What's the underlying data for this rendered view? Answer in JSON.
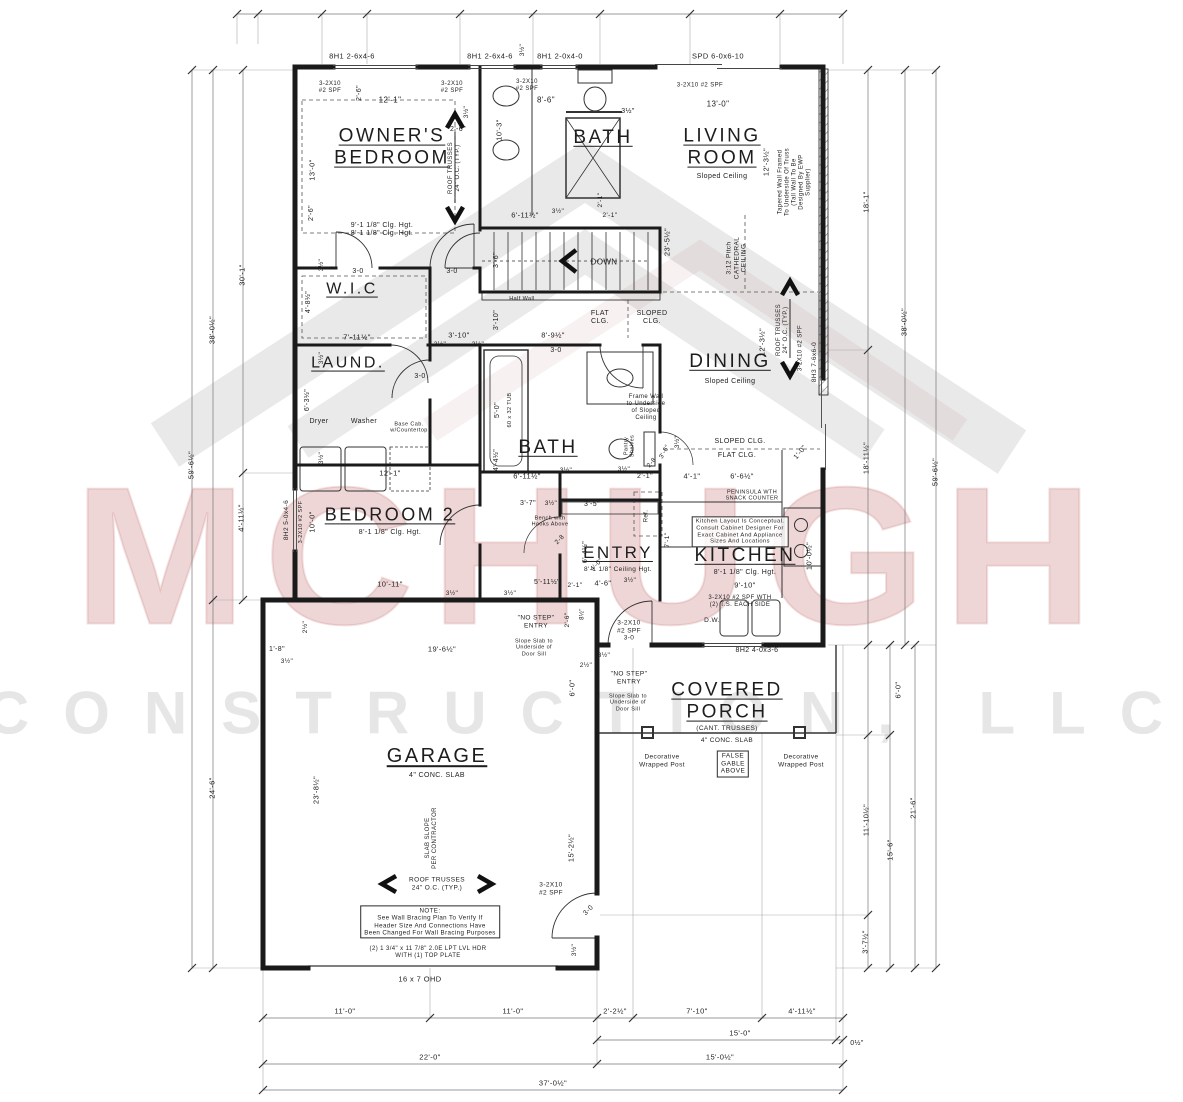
{
  "drawing": {
    "type": "Residential first-floor construction plan"
  },
  "watermark": {
    "line1": "MCHUGH",
    "line2": "CONSTRUCTION, LLC",
    "accent_color": "#cd8080"
  },
  "rooms": [
    {
      "name": "OWNER'S BEDROOM",
      "note": "9'-1 1/8\" Clg. Hgt. / 8'-1 1/8\" Clg. Hgt."
    },
    {
      "name": "BATH",
      "note": "upper bath"
    },
    {
      "name": "LIVING ROOM",
      "note": "Sloped Ceiling"
    },
    {
      "name": "W.I.C",
      "note": ""
    },
    {
      "name": "LAUND.",
      "note": ""
    },
    {
      "name": "DINING",
      "note": "Sloped Ceiling"
    },
    {
      "name": "BATH",
      "note": "hall bath"
    },
    {
      "name": "BEDROOM 2",
      "note": "8'-1 1/8\" Clg. Hgt."
    },
    {
      "name": "ENTRY",
      "note": "8'-1 1/8\" Ceiling Hgt."
    },
    {
      "name": "KITCHEN",
      "note": "8'-1 1/8\" Clg. Hgt."
    },
    {
      "name": "COVERED PORCH",
      "note": "(CANT. TRUSSES) 4\" CONC. SLAB"
    },
    {
      "name": "GARAGE",
      "note": "4\" CONC. SLAB"
    }
  ],
  "labels": [
    {
      "t": "8H1 2-6x4-6",
      "x": 352,
      "y": 57,
      "s": 7.5
    },
    {
      "t": "8H1 2-6x4-6",
      "x": 490,
      "y": 57,
      "s": 7.5
    },
    {
      "t": "8H1 2-0x4-0",
      "x": 560,
      "y": 57,
      "s": 7.5
    },
    {
      "t": "SPD 6-0x6-10",
      "x": 718,
      "y": 57,
      "s": 7.5
    },
    {
      "t": "3½\"",
      "x": 523,
      "y": 50,
      "s": 6.5,
      "r": -90
    },
    {
      "t": "3-2X10\n#2 SPF",
      "x": 330,
      "y": 88,
      "s": 6
    },
    {
      "t": "3-2X10\n#2 SPF",
      "x": 452,
      "y": 88,
      "s": 6
    },
    {
      "t": "3-2X10\n#2 SPF",
      "x": 527,
      "y": 86,
      "s": 6
    },
    {
      "t": "3-2X10 #2 SPF",
      "x": 700,
      "y": 86,
      "s": 6
    },
    {
      "t": "12'-1\"",
      "x": 390,
      "y": 100,
      "s": 8
    },
    {
      "t": "8'-6\"",
      "x": 546,
      "y": 100,
      "s": 8
    },
    {
      "t": "13'-0\"",
      "x": 718,
      "y": 104,
      "s": 8
    },
    {
      "t": "10'-3\"",
      "x": 500,
      "y": 130,
      "s": 7.5,
      "r": -90
    },
    {
      "t": "3½\"",
      "x": 628,
      "y": 112,
      "s": 7
    },
    {
      "t": "2'-6\"",
      "x": 360,
      "y": 93,
      "s": 7,
      "r": -90
    },
    {
      "t": "2'-6\"",
      "x": 458,
      "y": 130,
      "s": 7
    },
    {
      "t": "3½\"",
      "x": 467,
      "y": 112,
      "s": 6.5,
      "r": -90
    },
    {
      "t": "13'-0\"",
      "x": 313,
      "y": 170,
      "s": 7.5,
      "r": -90
    },
    {
      "t": "2'-6\"",
      "x": 312,
      "y": 213,
      "s": 7,
      "r": -90
    },
    {
      "t": "OWNER'S\nBEDROOM",
      "x": 392,
      "y": 148,
      "s": 19,
      "u": 1,
      "n": "room-label-owners-bedroom"
    },
    {
      "t": "BATH",
      "x": 603,
      "y": 138,
      "s": 19,
      "u": 1,
      "n": "room-label-bath-1"
    },
    {
      "t": "LIVING\nROOM",
      "x": 722,
      "y": 148,
      "s": 19,
      "u": 1,
      "n": "room-label-living-room"
    },
    {
      "t": "Sloped Ceiling",
      "x": 722,
      "y": 177,
      "s": 7
    },
    {
      "t": "ROOF TRUSSES\n24\" O.C. (TYP.)",
      "x": 455,
      "y": 168,
      "s": 6,
      "r": -90
    },
    {
      "t": "9'-1 1/8\" Clg. Hgt.\n8'-1 1/8\" Clg. Hgt.",
      "x": 382,
      "y": 230,
      "s": 7
    },
    {
      "t": "12'-3½\"",
      "x": 767,
      "y": 162,
      "s": 7.5,
      "r": -90
    },
    {
      "t": "Tapered Wall Framed\nTo Underside Of Truss\n(Tall Wall To Be\nDesigned By EWP\nSupplier)",
      "x": 795,
      "y": 182,
      "s": 6,
      "r": -90
    },
    {
      "t": "18'-1\"",
      "x": 867,
      "y": 202,
      "s": 7.5,
      "r": -90
    },
    {
      "t": "3:12 Pitch\nCATHEDRAL\nCEILING",
      "x": 737,
      "y": 258,
      "s": 6.5,
      "r": -90
    },
    {
      "t": "23'-5½\"",
      "x": 668,
      "y": 242,
      "s": 7.5,
      "r": -90
    },
    {
      "t": "2'-1\"",
      "x": 601,
      "y": 200,
      "s": 6.5,
      "r": -90
    },
    {
      "t": "6'-11½\"",
      "x": 525,
      "y": 216,
      "s": 7.5
    },
    {
      "t": "3½\"",
      "x": 558,
      "y": 212,
      "s": 6.5
    },
    {
      "t": "2'-1\"",
      "x": 610,
      "y": 216,
      "s": 6.5
    },
    {
      "t": "3-0",
      "x": 358,
      "y": 272,
      "s": 7
    },
    {
      "t": "3-0",
      "x": 452,
      "y": 272,
      "s": 7
    },
    {
      "t": "3'-6\"",
      "x": 497,
      "y": 260,
      "s": 7,
      "r": -90
    },
    {
      "t": "DOWN",
      "x": 604,
      "y": 262,
      "s": 8,
      "n": "stairs-down-label"
    },
    {
      "t": "Half Wall",
      "x": 522,
      "y": 299,
      "s": 5.5
    },
    {
      "t": "W.I.C",
      "x": 352,
      "y": 290,
      "s": 16,
      "u": 1,
      "n": "room-label-wic"
    },
    {
      "t": "4'-8½\"",
      "x": 309,
      "y": 302,
      "s": 7,
      "r": -90
    },
    {
      "t": "3½\"",
      "x": 322,
      "y": 265,
      "s": 6.5,
      "r": -90
    },
    {
      "t": "7'-11½\"",
      "x": 357,
      "y": 338,
      "s": 7.5
    },
    {
      "t": "3'-10\"",
      "x": 459,
      "y": 336,
      "s": 7.5
    },
    {
      "t": "3½\"",
      "x": 440,
      "y": 345,
      "s": 6.5
    },
    {
      "t": "3½\"",
      "x": 478,
      "y": 345,
      "s": 6.5
    },
    {
      "t": "8'-9½\"",
      "x": 553,
      "y": 336,
      "s": 7.5
    },
    {
      "t": "3'-10\"",
      "x": 497,
      "y": 320,
      "s": 7,
      "r": -90
    },
    {
      "t": "FLAT\nCLG.",
      "x": 600,
      "y": 318,
      "s": 7
    },
    {
      "t": "SLOPED\nCLG.",
      "x": 652,
      "y": 318,
      "s": 7
    },
    {
      "t": "LAUND.",
      "x": 348,
      "y": 364,
      "s": 16,
      "u": 1,
      "n": "room-label-laundry"
    },
    {
      "t": "3-0",
      "x": 420,
      "y": 377,
      "s": 7
    },
    {
      "t": "6'-3½\"",
      "x": 308,
      "y": 400,
      "s": 7,
      "r": -90
    },
    {
      "t": "3½\"",
      "x": 322,
      "y": 358,
      "s": 6.5,
      "r": -90
    },
    {
      "t": "Dryer",
      "x": 319,
      "y": 422,
      "s": 7
    },
    {
      "t": "Washer",
      "x": 364,
      "y": 422,
      "s": 7
    },
    {
      "t": "Base Cab.\nw/Countertop",
      "x": 409,
      "y": 428,
      "s": 5.5
    },
    {
      "t": "3½\"",
      "x": 322,
      "y": 458,
      "s": 6.5,
      "r": -90
    },
    {
      "t": "12'-1\"",
      "x": 390,
      "y": 474,
      "s": 7.5
    },
    {
      "t": "DINING",
      "x": 730,
      "y": 362,
      "s": 19,
      "u": 1,
      "n": "room-label-dining"
    },
    {
      "t": "Sloped Ceiling",
      "x": 730,
      "y": 382,
      "s": 7
    },
    {
      "t": "12'-3½\"",
      "x": 763,
      "y": 342,
      "s": 7.5,
      "r": -90
    },
    {
      "t": "ROOF TRUSSES\n24\" O.C. (TYP.)",
      "x": 783,
      "y": 330,
      "s": 6,
      "r": -90
    },
    {
      "t": "3-2X10 #2 SPF",
      "x": 801,
      "y": 348,
      "s": 6,
      "r": -90
    },
    {
      "t": "8H3 7-6x6-0",
      "x": 815,
      "y": 362,
      "s": 6.5,
      "r": -90
    },
    {
      "t": "38'-0½\"",
      "x": 905,
      "y": 322,
      "s": 7.5,
      "r": -90
    },
    {
      "t": "59'-6½\"",
      "x": 936,
      "y": 472,
      "s": 7.5,
      "r": -90
    },
    {
      "t": "18'-11½\"",
      "x": 867,
      "y": 458,
      "s": 7.5,
      "r": -90
    },
    {
      "t": "BATH",
      "x": 548,
      "y": 448,
      "s": 19,
      "u": 1,
      "n": "room-label-bath-2"
    },
    {
      "t": "5'-0\"",
      "x": 498,
      "y": 410,
      "s": 7,
      "r": -90
    },
    {
      "t": "60 x 32 TUB",
      "x": 510,
      "y": 410,
      "s": 5.5,
      "r": -90
    },
    {
      "t": "3-0",
      "x": 556,
      "y": 351,
      "s": 7
    },
    {
      "t": "Frame Wall\nto Underside\nof Sloped\nCeiling",
      "x": 646,
      "y": 408,
      "s": 6
    },
    {
      "t": "SLOPED CLG.",
      "x": 740,
      "y": 442,
      "s": 7
    },
    {
      "t": "FLAT CLG.",
      "x": 737,
      "y": 456,
      "s": 7
    },
    {
      "t": "1'-0\"",
      "x": 801,
      "y": 453,
      "s": 7,
      "r": -50
    },
    {
      "t": "4'-4½\"",
      "x": 497,
      "y": 460,
      "s": 7,
      "r": -90
    },
    {
      "t": "6'-11½\"",
      "x": 527,
      "y": 477,
      "s": 7.5
    },
    {
      "t": "3½\"",
      "x": 566,
      "y": 471,
      "s": 6.5
    },
    {
      "t": "2'-1\"",
      "x": 645,
      "y": 477,
      "s": 7
    },
    {
      "t": "3½\"",
      "x": 624,
      "y": 470,
      "s": 6.5
    },
    {
      "t": "Pantry\nShelves",
      "x": 630,
      "y": 446,
      "s": 5.5,
      "r": -90
    },
    {
      "t": "2-8",
      "x": 652,
      "y": 463,
      "s": 6.5,
      "r": -50
    },
    {
      "t": "3'-6\"",
      "x": 665,
      "y": 452,
      "s": 6.5,
      "r": -60
    },
    {
      "t": "4'-1\"",
      "x": 692,
      "y": 477,
      "s": 7.5
    },
    {
      "t": "6'-6½\"",
      "x": 742,
      "y": 477,
      "s": 7.5
    },
    {
      "t": "3½\"",
      "x": 678,
      "y": 442,
      "s": 6.5,
      "r": -90
    },
    {
      "t": "PENINSULA WTH\nSNACK COUNTER",
      "x": 752,
      "y": 496,
      "s": 5.5
    },
    {
      "t": "BEDROOM 2",
      "x": 390,
      "y": 515,
      "s": 18,
      "u": 1,
      "n": "room-label-bedroom-2"
    },
    {
      "t": "8'-1 1/8\" Clg. Hgt.",
      "x": 390,
      "y": 533,
      "s": 7
    },
    {
      "t": "10'-0\"",
      "x": 313,
      "y": 522,
      "s": 7.5,
      "r": -90
    },
    {
      "t": "8H2 5-0x4-6",
      "x": 287,
      "y": 520,
      "s": 6.5,
      "r": -90
    },
    {
      "t": "3-2X10 #2 SPF",
      "x": 301,
      "y": 522,
      "s": 5.5,
      "r": -90
    },
    {
      "t": "10'-11\"",
      "x": 390,
      "y": 585,
      "s": 7.5
    },
    {
      "t": "3½\"",
      "x": 452,
      "y": 594,
      "s": 6.5
    },
    {
      "t": "2'-1\"",
      "x": 575,
      "y": 586,
      "s": 6.5
    },
    {
      "t": "3½\"",
      "x": 510,
      "y": 594,
      "s": 6.5
    },
    {
      "t": "5'-11½\"",
      "x": 547,
      "y": 583,
      "s": 7
    },
    {
      "t": "30'-1\"",
      "x": 243,
      "y": 275,
      "s": 7.5,
      "r": -90
    },
    {
      "t": "38'-0½\"",
      "x": 213,
      "y": 330,
      "s": 7.5,
      "r": -90
    },
    {
      "t": "59'-6½\"",
      "x": 192,
      "y": 465,
      "s": 7.5,
      "r": -90
    },
    {
      "t": "4'-11½\"",
      "x": 242,
      "y": 518,
      "s": 7.5,
      "r": -90
    },
    {
      "t": "ENTRY",
      "x": 618,
      "y": 553,
      "s": 17,
      "u": 1,
      "n": "room-label-entry"
    },
    {
      "t": "8'-1 1/8\" Ceiling Hgt.",
      "x": 618,
      "y": 570,
      "s": 6.5
    },
    {
      "t": "4'-6\"",
      "x": 603,
      "y": 584,
      "s": 7.5
    },
    {
      "t": "3½\"",
      "x": 630,
      "y": 581,
      "s": 6.5
    },
    {
      "t": "KITCHEN",
      "x": 745,
      "y": 556,
      "s": 19,
      "u": 1,
      "n": "room-label-kitchen"
    },
    {
      "t": "8'-1 1/8\" Clg. Hgt.",
      "x": 745,
      "y": 573,
      "s": 7
    },
    {
      "t": "9'-10\"",
      "x": 745,
      "y": 586,
      "s": 7.5
    },
    {
      "t": "Kitchen Layout Is Conceptual.\nConsult Cabinet Designer For\nExact Cabinet And Appliance\nSizes And Locations",
      "x": 740,
      "y": 532,
      "s": 5.8,
      "bx": 1
    },
    {
      "t": "10'-0½\"",
      "x": 810,
      "y": 556,
      "s": 7.5,
      "r": -90
    },
    {
      "t": "3-2X10 #2 SPF WTH\n(2) T.S. EACH SIDE",
      "x": 740,
      "y": 602,
      "s": 6
    },
    {
      "t": "D.W.",
      "x": 712,
      "y": 621,
      "s": 6.5
    },
    {
      "t": "Ref.",
      "x": 647,
      "y": 516,
      "s": 6,
      "r": -90
    },
    {
      "t": "7'-1\"",
      "x": 668,
      "y": 540,
      "s": 6.5,
      "r": -90
    },
    {
      "t": "3'-7\"",
      "x": 528,
      "y": 504,
      "s": 7
    },
    {
      "t": "3½\"",
      "x": 551,
      "y": 504,
      "s": 6.5
    },
    {
      "t": "3'-5\"",
      "x": 592,
      "y": 505,
      "s": 7
    },
    {
      "t": "Bench with\nHooks Above",
      "x": 550,
      "y": 522,
      "s": 5.5
    },
    {
      "t": "2-8",
      "x": 560,
      "y": 540,
      "s": 6.5,
      "r": -45
    },
    {
      "t": "6'-4½\"",
      "x": 586,
      "y": 552,
      "s": 7,
      "r": -90
    },
    {
      "t": "4'-0\"",
      "x": 597,
      "y": 565,
      "s": 6.5,
      "r": -45
    },
    {
      "t": "3-2X10\n#2 SPF\n3-0",
      "x": 629,
      "y": 631,
      "s": 6.5
    },
    {
      "t": "2'-6\"",
      "x": 568,
      "y": 620,
      "s": 6.5,
      "r": -90
    },
    {
      "t": "8½\"",
      "x": 583,
      "y": 614,
      "s": 6,
      "r": -90
    },
    {
      "t": "\"NO STEP\"\nENTRY",
      "x": 536,
      "y": 622,
      "s": 6.5
    },
    {
      "t": "Slope Slab to\nUnderside of\nDoor Sill",
      "x": 534,
      "y": 648,
      "s": 5.5
    },
    {
      "t": "3½\"",
      "x": 604,
      "y": 656,
      "s": 6.5
    },
    {
      "t": "2½\"",
      "x": 586,
      "y": 666,
      "s": 6.5
    },
    {
      "t": "19'-6½\"",
      "x": 442,
      "y": 650,
      "s": 7.5
    },
    {
      "t": "1'-8\"",
      "x": 277,
      "y": 650,
      "s": 7
    },
    {
      "t": "3½\"",
      "x": 287,
      "y": 662,
      "s": 6.5
    },
    {
      "t": "2½\"",
      "x": 306,
      "y": 627,
      "s": 6.5,
      "r": -90
    },
    {
      "t": "24'-6\"",
      "x": 213,
      "y": 788,
      "s": 7.5,
      "r": -90
    },
    {
      "t": "23'-8½\"",
      "x": 317,
      "y": 790,
      "s": 7.5,
      "r": -90
    },
    {
      "t": "GARAGE",
      "x": 437,
      "y": 757,
      "s": 20,
      "u": 1,
      "n": "room-label-garage"
    },
    {
      "t": "4\" CONC. SLAB",
      "x": 437,
      "y": 776,
      "s": 7
    },
    {
      "t": "SLAB SLOPE\nPER CONTRACTOR",
      "x": 432,
      "y": 838,
      "s": 6,
      "r": -90
    },
    {
      "t": "ROOF TRUSSES\n24\" O.C. (TYP.)",
      "x": 437,
      "y": 884,
      "s": 6.5
    },
    {
      "t": "NOTE:\nSee Wall Bracing Plan To Verify If\nHeader Size And Connections Have\nBeen Changed For Wall Bracing Purposes",
      "x": 430,
      "y": 922,
      "s": 6.2,
      "bx": 1
    },
    {
      "t": "(2) 1 3/4\" x 11 7/8\" 2.0E LPT LVL HDR\nWITH (1) TOP PLATE",
      "x": 428,
      "y": 953,
      "s": 6
    },
    {
      "t": "16 x 7 OHD",
      "x": 420,
      "y": 980,
      "s": 7.5
    },
    {
      "t": "6'-0\"",
      "x": 573,
      "y": 688,
      "s": 7.5,
      "r": -90
    },
    {
      "t": "15'-2½\"",
      "x": 572,
      "y": 848,
      "s": 7.5,
      "r": -90
    },
    {
      "t": "3-2X10\n#2 SPF",
      "x": 551,
      "y": 889,
      "s": 6.5
    },
    {
      "t": "3-0",
      "x": 589,
      "y": 911,
      "s": 7,
      "r": -45
    },
    {
      "t": "3½\"",
      "x": 575,
      "y": 950,
      "s": 6.5,
      "r": -90
    },
    {
      "t": "8H2 4-0x3-6",
      "x": 757,
      "y": 651,
      "s": 7
    },
    {
      "t": "COVERED\nPORCH",
      "x": 727,
      "y": 702,
      "s": 19,
      "u": 1,
      "n": "room-label-covered-porch"
    },
    {
      "t": "(CANT. TRUSSES)",
      "x": 727,
      "y": 729,
      "s": 6.5
    },
    {
      "t": "4\" CONC. SLAB",
      "x": 727,
      "y": 741,
      "s": 6.5
    },
    {
      "t": "\"NO STEP\"\nENTRY",
      "x": 629,
      "y": 678,
      "s": 6.5
    },
    {
      "t": "Slope Slab to\nUnderside of\nDoor Sill",
      "x": 628,
      "y": 703,
      "s": 5.5
    },
    {
      "t": "Decorative\nWrapped Post",
      "x": 662,
      "y": 761,
      "s": 6.5
    },
    {
      "t": "FALSE\nGABLE\nABOVE",
      "x": 733,
      "y": 764,
      "s": 6.5,
      "bx": 1
    },
    {
      "t": "Decorative\nWrapped Post",
      "x": 801,
      "y": 761,
      "s": 6.5
    },
    {
      "t": "6'-0\"",
      "x": 899,
      "y": 690,
      "s": 7.5,
      "r": -90
    },
    {
      "t": "11'-10½\"",
      "x": 867,
      "y": 820,
      "s": 7.5,
      "r": -90
    },
    {
      "t": "15'-6\"",
      "x": 891,
      "y": 850,
      "s": 7.5,
      "r": -90
    },
    {
      "t": "21'-6\"",
      "x": 914,
      "y": 808,
      "s": 7.5,
      "r": -90
    },
    {
      "t": "3'-7½\"",
      "x": 866,
      "y": 942,
      "s": 7.5,
      "r": -90
    },
    {
      "t": "11'-0\"",
      "x": 345,
      "y": 1012,
      "s": 7.5
    },
    {
      "t": "11'-0\"",
      "x": 513,
      "y": 1012,
      "s": 7.5
    },
    {
      "t": "2'-2½\"",
      "x": 615,
      "y": 1012,
      "s": 7.5
    },
    {
      "t": "7'-10\"",
      "x": 697,
      "y": 1012,
      "s": 7.5
    },
    {
      "t": "4'-11½\"",
      "x": 802,
      "y": 1012,
      "s": 7.5
    },
    {
      "t": "15'-0\"",
      "x": 740,
      "y": 1034,
      "s": 7.5
    },
    {
      "t": "0½\"",
      "x": 857,
      "y": 1044,
      "s": 7
    },
    {
      "t": "22'-0\"",
      "x": 430,
      "y": 1058,
      "s": 7.5
    },
    {
      "t": "15'-0½\"",
      "x": 720,
      "y": 1058,
      "s": 7.5
    },
    {
      "t": "37'-0½\"",
      "x": 553,
      "y": 1084,
      "s": 7.5
    }
  ]
}
